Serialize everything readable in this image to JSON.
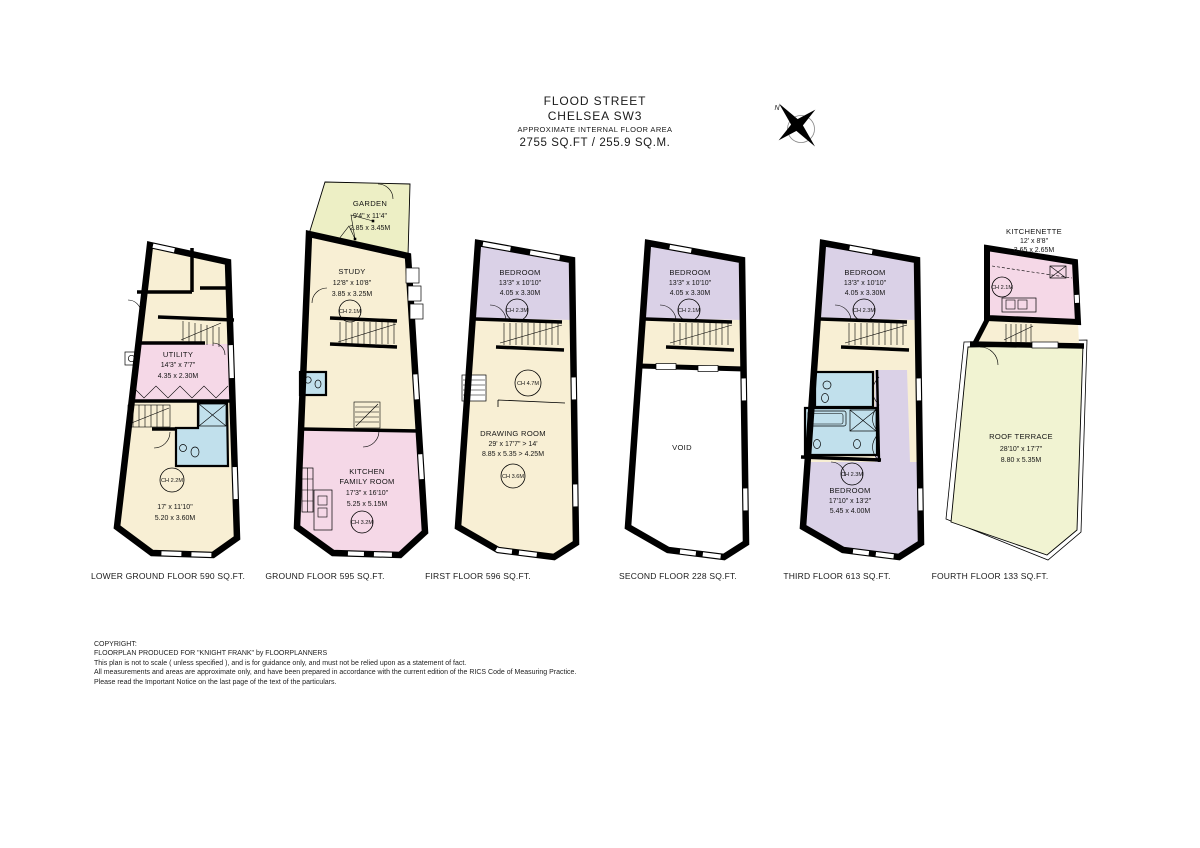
{
  "title": {
    "street": "FLOOD STREET",
    "area": "CHELSEA SW3",
    "note": "APPROXIMATE INTERNAL FLOOR AREA",
    "size": "2755 SQ.FT / 255.9 SQ.M."
  },
  "compass": {
    "north": "N"
  },
  "floors": {
    "lower_ground": {
      "label": "LOWER GROUND FLOOR 590 SQ.FT.",
      "utility": {
        "title": "UTILITY",
        "imperial": "14'3\" x 7'7\"",
        "metric": "4.35 x 2.30M"
      },
      "reception": {
        "imperial": "17' x 11'10\"",
        "metric": "5.20 x 3.60M",
        "ceiling": "CH 2.2M"
      }
    },
    "ground": {
      "label": "GROUND FLOOR 595 SQ.FT.",
      "garden": {
        "title": "GARDEN",
        "imperial": "9'4\" x 11'4\"",
        "metric": "2.85 x 3.45M"
      },
      "study": {
        "title": "STUDY",
        "imperial": "12'8\" x 10'8\"",
        "metric": "3.85 x 3.25M",
        "ceiling": "CH 2.1M"
      },
      "kitchen": {
        "title_line1": "KITCHEN",
        "title_line2": "FAMILY ROOM",
        "imperial": "17'3\" x 16'10\"",
        "metric": "5.25 x 5.15M",
        "ceiling": "CH 3.2M"
      }
    },
    "first": {
      "label": "FIRST FLOOR 596 SQ.FT.",
      "bedroom": {
        "title": "BEDROOM",
        "imperial": "13'3\" x 10'10\"",
        "metric": "4.05 x 3.30M",
        "ceiling": "CH 2.3M"
      },
      "drawing_room": {
        "title": "DRAWING ROOM",
        "imperial": "29' x 17'7\" > 14'",
        "metric": "8.85 x 5.35 > 4.25M",
        "ceiling_front": "CH 4.7M",
        "ceiling_rear": "CH 3.6M"
      }
    },
    "second": {
      "label": "SECOND FLOOR 228 SQ.FT.",
      "bedroom": {
        "title": "BEDROOM",
        "imperial": "13'3\" x 10'10\"",
        "metric": "4.05 x 3.30M",
        "ceiling": "CH 2.1M"
      },
      "void": {
        "title": "VOID"
      }
    },
    "third": {
      "label": "THIRD FLOOR 613 SQ.FT.",
      "bedroom_front": {
        "title": "BEDROOM",
        "imperial": "13'3\" x 10'10\"",
        "metric": "4.05 x 3.30M",
        "ceiling": "CH 2.3M"
      },
      "bedroom_rear": {
        "title": "BEDROOM",
        "imperial": "17'10\" x 13'2\"",
        "metric": "5.45 x 4.00M",
        "ceiling": "CH 2.3M"
      }
    },
    "fourth": {
      "label": "FOURTH FLOOR 133 SQ.FT.",
      "kitchenette": {
        "title": "KITCHENETTE",
        "imperial": "12' x 8'8\"",
        "metric": "3.65 x 2.65M",
        "ceiling": "CH 2.1M"
      },
      "roof_terrace": {
        "title": "ROOF TERRACE",
        "imperial": "28'10\" x 17'7\"",
        "metric": "8.80 x 5.35M"
      }
    }
  },
  "copyright": {
    "line1": "COPYRIGHT:",
    "line2": "FLOORPLAN PRODUCED FOR \"KNIGHT FRANK\" by FLOORPLANNERS",
    "line3": "This plan is not to scale  ( unless specified ), and is for guidance only, and must not be relied upon as a statement of fact.",
    "line4": "All measurements and areas are approximate only, and have been prepared in accordance with the current edition of the RICS Code of Measuring Practice.",
    "line5": "Please read the Important Notice on the last page of the text of the particulars."
  },
  "colors": {
    "room_cream": "#F8EFD4",
    "room_pink": "#F5D8E7",
    "room_purple": "#DAD1E7",
    "room_blue": "#C1E0EC",
    "garden_green": "#EDEFC5",
    "terrace_green": "#F1F3D2",
    "wall": "#000000"
  }
}
